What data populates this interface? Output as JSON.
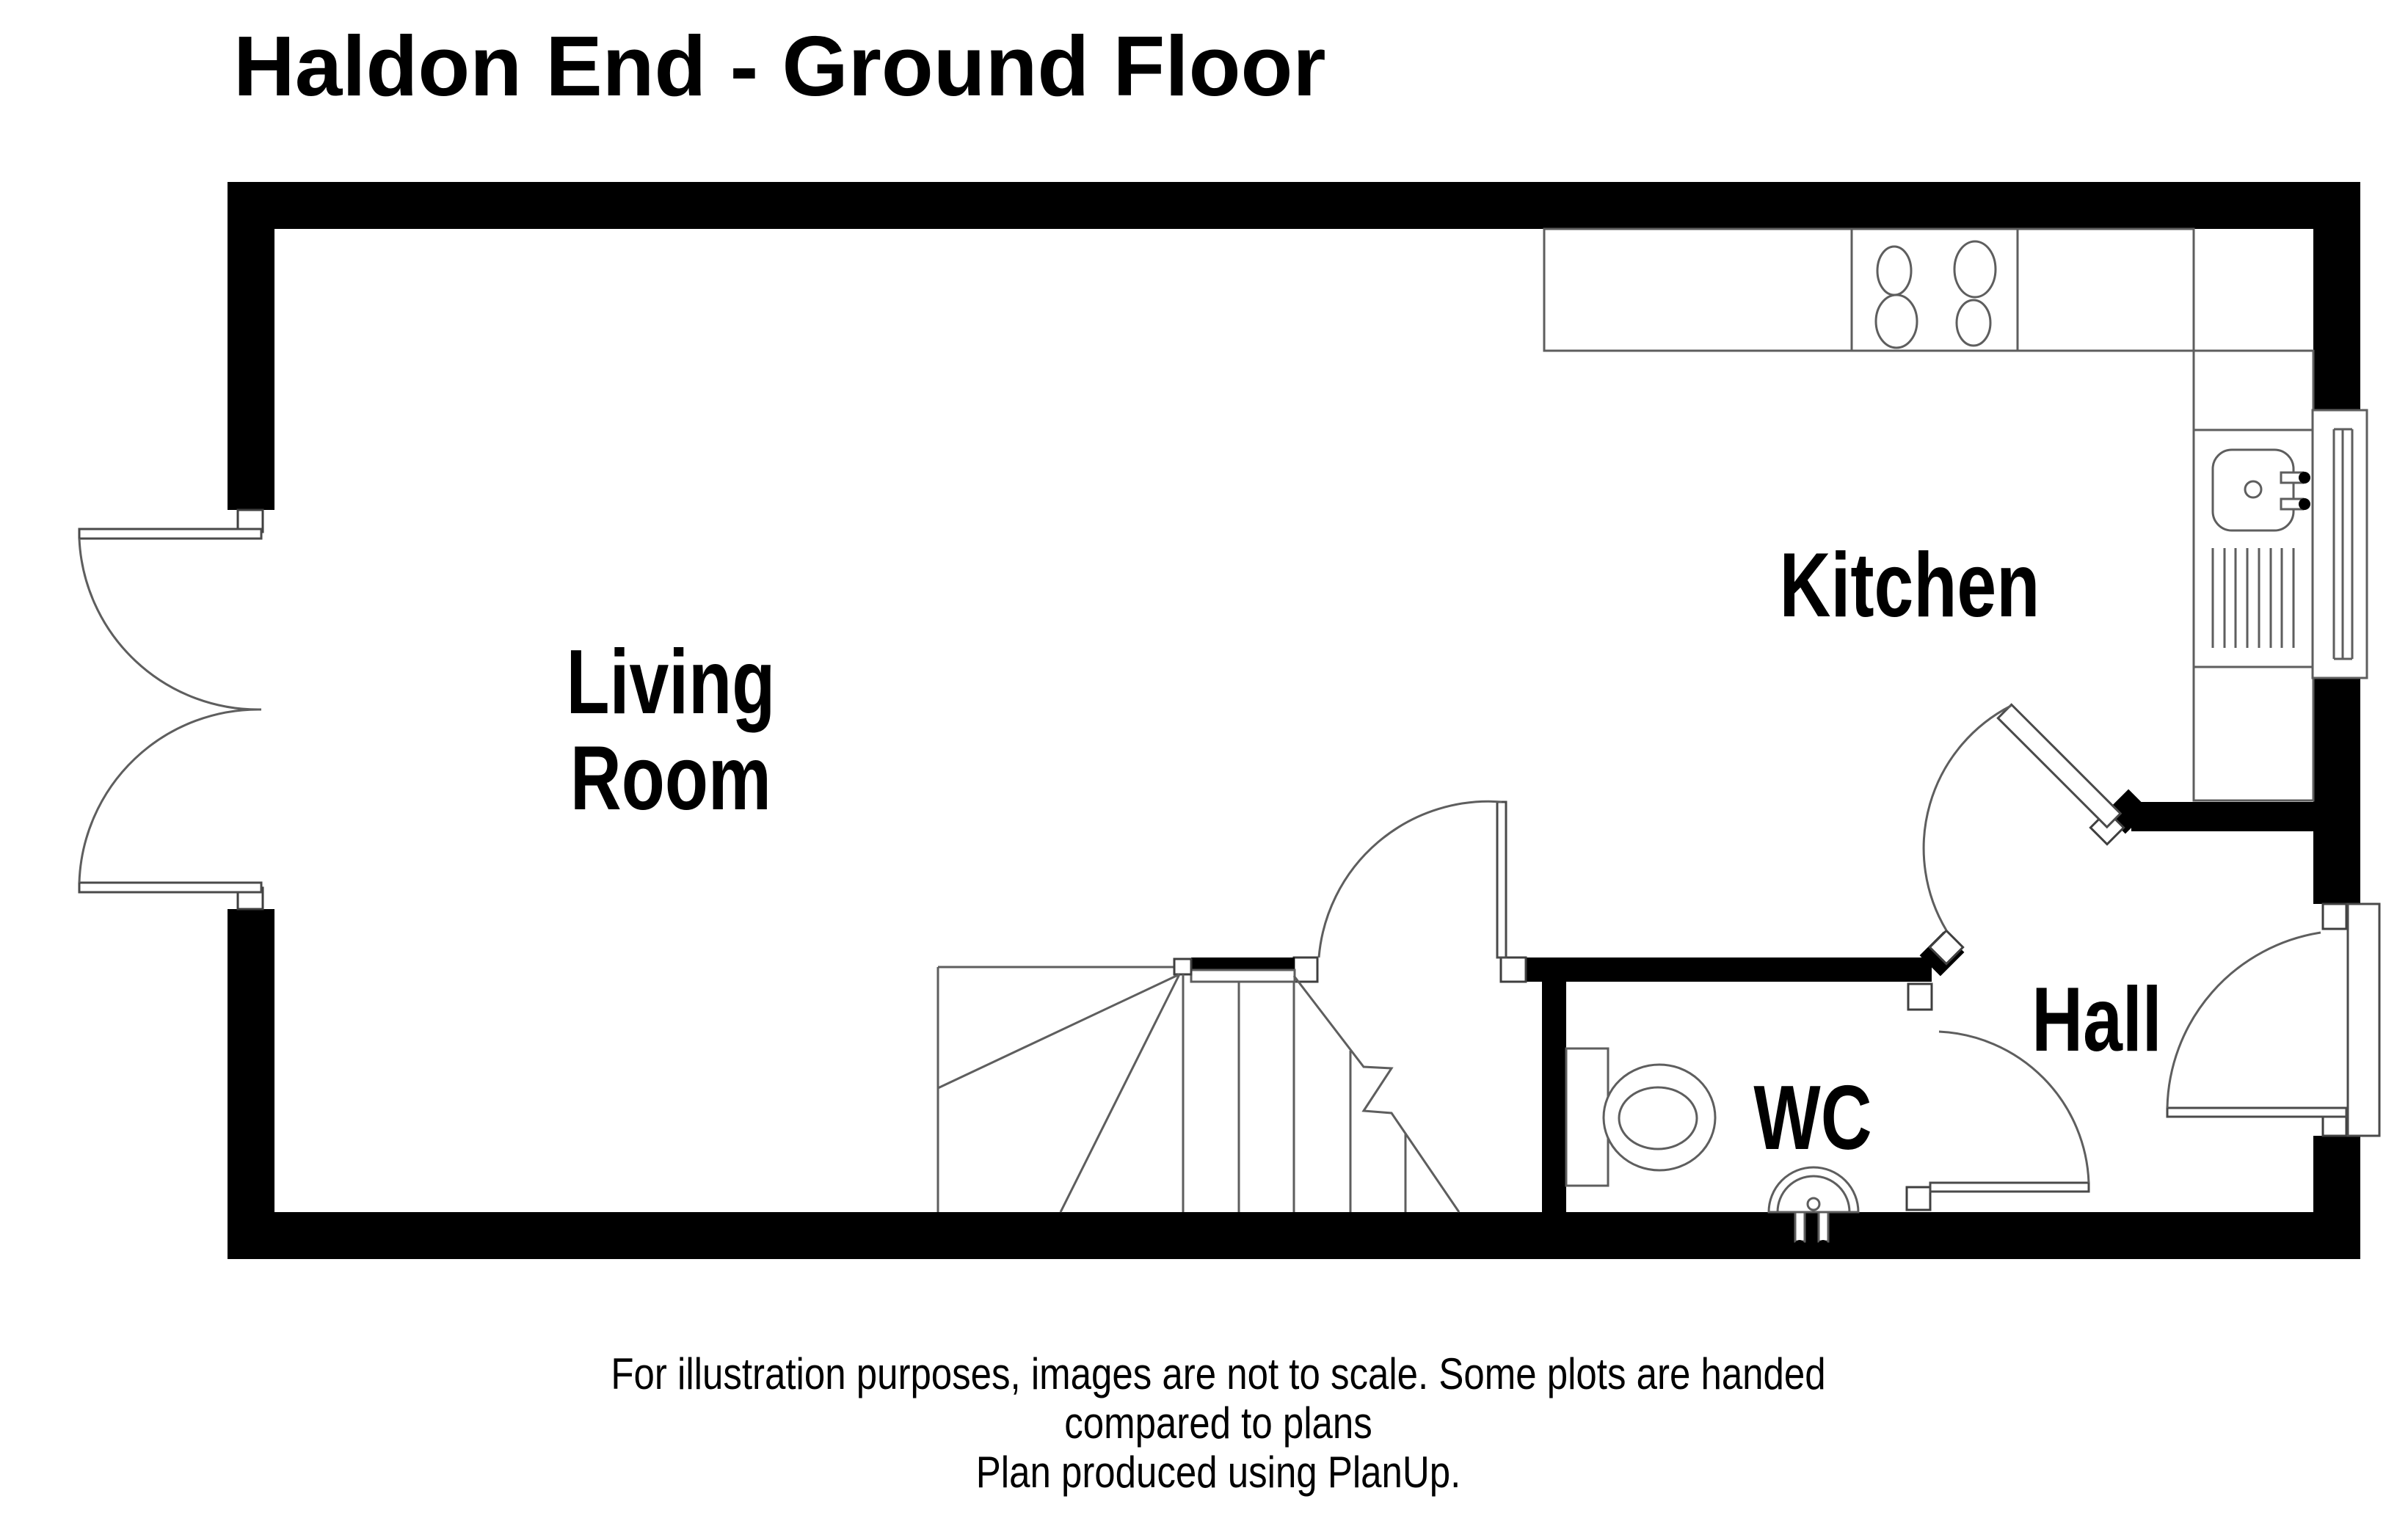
{
  "title": "Haldon End - Ground Floor",
  "rooms": {
    "living_room": {
      "label_line1": "Living",
      "label_line2": "Room"
    },
    "kitchen": {
      "label": "Kitchen"
    },
    "hall": {
      "label": "Hall"
    },
    "wc": {
      "label": "WC"
    }
  },
  "disclaimer": {
    "line1": "For illustration purposes, images are not to scale. Some plots are handed",
    "line2": "compared to plans",
    "line3": "Plan produced using PlanUp."
  },
  "fixtures": {
    "hob": "hob-4-burners",
    "sink": "kitchen-sink-with-drainer",
    "window": "kitchen-window",
    "toilet": "toilet-with-cistern",
    "basin": "wc-basin-with-taps",
    "stairs": "winder-staircase",
    "patio_door": "double-patio-door",
    "front_door": "front-door",
    "kitchen_door": "kitchen-door",
    "wc_door": "wc-door",
    "living_room_door": "living-room-door"
  },
  "colors": {
    "wall": "#000000",
    "line": "#5e5e5e",
    "background": "#ffffff",
    "text": "#000000"
  }
}
